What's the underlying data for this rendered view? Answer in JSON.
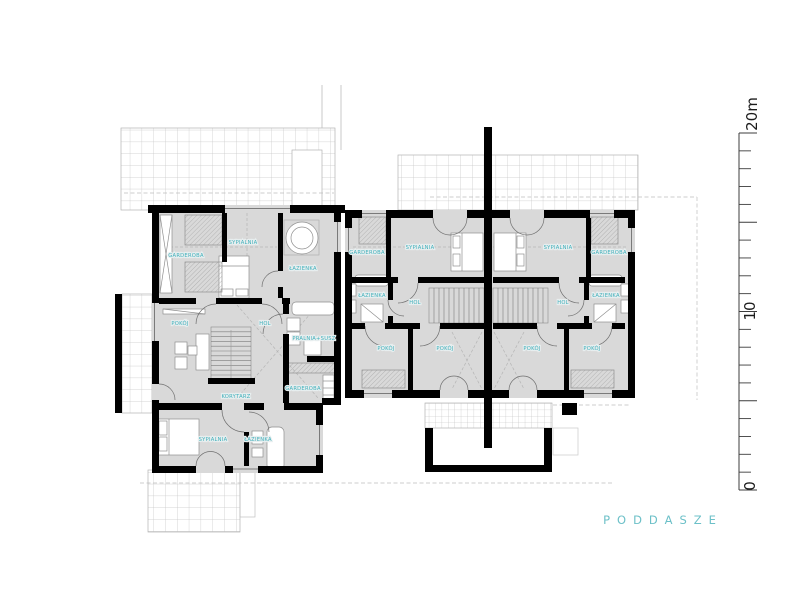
{
  "title": {
    "text": "PODDASZE"
  },
  "scale_bar": {
    "top_label": "20m",
    "mid_label": "10",
    "bottom_label": "0",
    "unit": "m",
    "range": [
      0,
      20
    ]
  },
  "colors": {
    "room_label_teal": "#3fafba",
    "title_teal": "#6cc0c8",
    "floor_gray": "#d9d9d9",
    "wall_black": "#000000",
    "roof_grid_gray": "#c6c6c6"
  },
  "rooms": [
    {
      "id": "a-garderoba",
      "label": "GARDEROBA"
    },
    {
      "id": "a-sypialnia-1",
      "label": "SYPIALNIA"
    },
    {
      "id": "a-lazienka-1",
      "label": "ŁAZIENKA"
    },
    {
      "id": "a-pokoj",
      "label": "POKÓJ"
    },
    {
      "id": "a-hol",
      "label": "HOL"
    },
    {
      "id": "a-pralnia",
      "label": "PRALNIA+SUSZ"
    },
    {
      "id": "a-garderoba-2",
      "label": "GARDEROBA"
    },
    {
      "id": "a-korytarz",
      "label": "KORYTARZ"
    },
    {
      "id": "a-sypialnia-2",
      "label": "SYPIALNIA"
    },
    {
      "id": "a-lazienka-2",
      "label": "ŁAZIENKA"
    },
    {
      "id": "b-garderoba",
      "label": "GARDEROBA"
    },
    {
      "id": "b-sypialnia",
      "label": "SYPIALNIA"
    },
    {
      "id": "b-lazienka",
      "label": "ŁAZIENKA"
    },
    {
      "id": "b-hol",
      "label": "HOL"
    },
    {
      "id": "b-pokoj-1",
      "label": "POKÓJ"
    },
    {
      "id": "b-pokoj-2",
      "label": "POKÓJ"
    },
    {
      "id": "c-sypialnia",
      "label": "SYPIALNIA"
    },
    {
      "id": "c-garderoba",
      "label": "GARDEROBA"
    },
    {
      "id": "c-hol",
      "label": "HOL"
    },
    {
      "id": "c-lazienka",
      "label": "ŁAZIENKA"
    },
    {
      "id": "c-pokoj-1",
      "label": "POKÓJ"
    },
    {
      "id": "c-pokoj-2",
      "label": "POKÓJ"
    }
  ]
}
